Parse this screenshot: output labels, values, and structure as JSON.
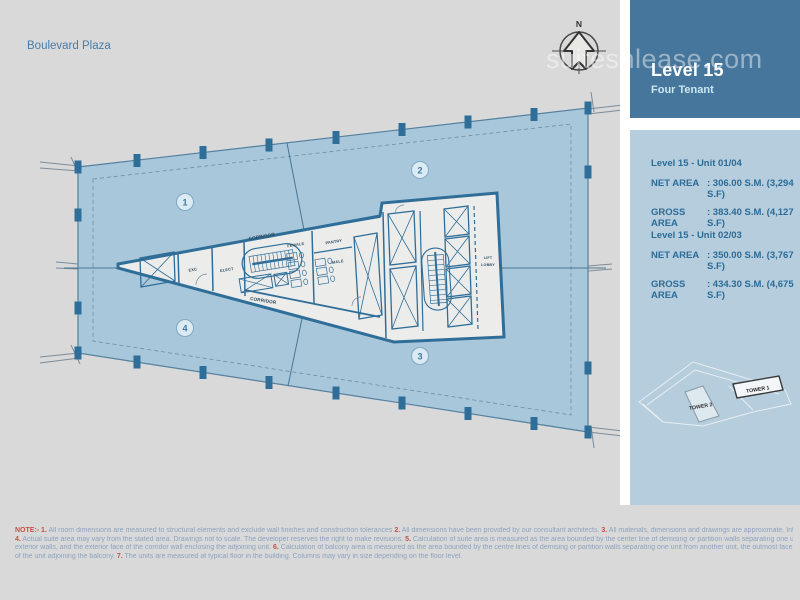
{
  "page": {
    "title": "Boulevard Plaza",
    "watermark": "suitesnlease.com"
  },
  "compass": {
    "north": "N"
  },
  "plan": {
    "quadrants": [
      "1",
      "2",
      "3",
      "4"
    ],
    "rooms": {
      "corridor_top": "CORRIDOR",
      "corridor_bottom": "CORRIDOR",
      "exc": "EXC",
      "elect": "ELECT",
      "female": "FEMALE",
      "male": "MALE",
      "pantry": "PANTRY",
      "lift": "LIFT",
      "lobby": "LOBBY"
    }
  },
  "sidebar": {
    "header": {
      "title": "Level 15",
      "subtitle": "Four Tenant"
    },
    "units": [
      {
        "name": "Level 15 - Unit  01/04",
        "rows": [
          {
            "label": "NET AREA",
            "value": ": 306.00 S.M. (3,294 S.F)"
          },
          {
            "label": "GROSS AREA",
            "value": ": 383.40 S.M. (4,127 S.F)"
          }
        ]
      },
      {
        "name": "Level 15 - Unit  02/03",
        "rows": [
          {
            "label": "NET AREA",
            "value": ": 350.00 S.M. (3,767 S.F)"
          },
          {
            "label": "GROSS AREA",
            "value": ": 434.30 S.M. (4,675 S.F)"
          }
        ]
      }
    ],
    "site_map": {
      "tower1": "TOWER 1",
      "tower2": "TOWER 2"
    }
  },
  "notes": {
    "lines": [
      [
        {
          "t": "NOTE:- 1.",
          "red": true
        },
        {
          "t": " All room dimensions are measured to structural elements and exclude wall finishes and construction tolerances "
        },
        {
          "t": "2.",
          "red": true
        },
        {
          "t": " All dimensions have been provided by our consultant architects. "
        },
        {
          "t": "3.",
          "red": true
        },
        {
          "t": " All materials, dimensions and drawings are approximate. Information subject to change without notice."
        }
      ],
      [
        {
          "t": "4.",
          "red": true
        },
        {
          "t": " Actual suite area may vary from the stated area. Drawings not to scale. The developer reserves the right to make revisions. "
        },
        {
          "t": "5.",
          "red": true
        },
        {
          "t": " Calculation of suite area is measured as the area bounded by the center line of demising or partition walls separating one unit from another unit, the exterior face of all the"
        }
      ],
      [
        {
          "t": "exterior walls, and the exterior face of the corridor wall enclosing the adjoining unit. "
        },
        {
          "t": "6.",
          "red": true
        },
        {
          "t": " Calculation of balcony area is measured as the area bounded by the centre lines of demising or partition walls separating one unit from another unit, the outmost face of the enclosing guard and the external face"
        }
      ],
      [
        {
          "t": "of the unit adjoining the balcony. "
        },
        {
          "t": "7.",
          "red": true
        },
        {
          "t": " The units are measured at typical floor in the building. Columns may vary in size depending on the floor level."
        }
      ]
    ]
  },
  "colors": {
    "wall_blue": "#2F6E99",
    "plan_fill": "#A9C7DA",
    "header_bg": "#46769B",
    "panel_bg": "#B5CDDC",
    "note_red": "#C1534B"
  }
}
